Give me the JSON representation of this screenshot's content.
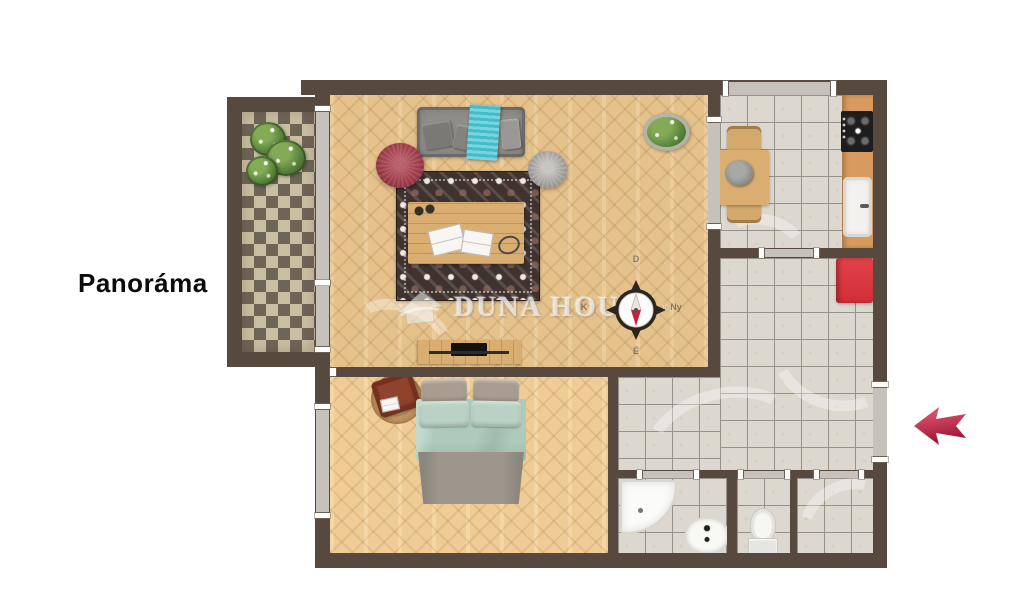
{
  "labels": {
    "panorama": "Panoráma",
    "watermark": "DUNA HOUSE",
    "registered": "®"
  },
  "compass": {
    "top": "D",
    "bottom": "É",
    "left": "K",
    "right": "Ny"
  },
  "colors": {
    "wall": "#57493d",
    "wood": "#e5c28c",
    "tile": "#dcd7cf",
    "grout": "#97918a",
    "checker_dark": "#6f6557",
    "checker_light": "#cabfa2",
    "window_gray": "#c6c2bb",
    "counter": "#d99a5d",
    "stove": "#1d1d1d",
    "cabinet_red": "#d12f38",
    "arrow_light": "#e85f7d",
    "arrow_dark": "#9d1630",
    "sofa": "#8f8d8a",
    "throw": "#49c7d6",
    "pouf_red": "#9e3b49",
    "pouf_gray": "#a3a19e",
    "rug_dark": "#40332f",
    "rug_light": "#f0e9e1",
    "table_wood": "#d9ae70",
    "bed_teal": "#adcaba",
    "bed_gray": "#9c968c",
    "pillow_gray": "#a89d90",
    "pillow_teal": "#bad2c5",
    "chair_rust": "#8f422c",
    "plant_green": "#55813a",
    "needle_red": "#c22343",
    "compass_ring": "#2d2620",
    "letter_gray": "#6f675c"
  }
}
